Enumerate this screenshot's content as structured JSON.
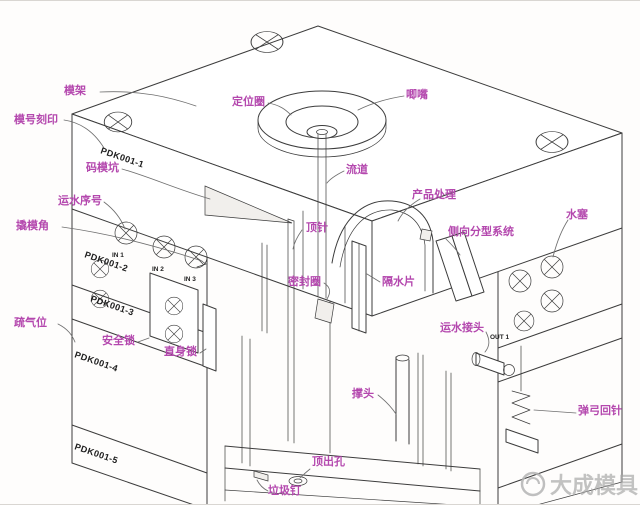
{
  "diagram": {
    "labels": {
      "mold_base": "模架",
      "mold_number_stamp": "模号刻印",
      "clamp_slot": "码模坑",
      "water_line_number": "运水序号",
      "pry_corner": "撬模角",
      "vent_slot": "疏气位",
      "safety_lock": "安全锁",
      "straight_lock": "直身锁",
      "locating_ring": "定位圈",
      "sprue_bush": "唧嘴",
      "runner": "流道",
      "product_area": "产品处理",
      "side_parting_system": "侧向分型系统",
      "ejector_pin": "顶针",
      "seal_ring": "密封圈",
      "water_baffle": "隔水片",
      "water_plug": "水塞",
      "water_fitting": "运水接头",
      "support_pillar": "撑头",
      "spring_return_pin": "弹弓回针",
      "ejection_hole": "顶出孔",
      "stop_pin": "垃圾钉"
    },
    "plate_numbers": {
      "p1": "PDK001-1",
      "p2": "PDK001-2",
      "p3": "PDK001-3",
      "p4": "PDK001-4",
      "p5": "PDK001-5"
    },
    "ports": {
      "in1": "IN 1",
      "in2": "IN 2",
      "in3": "IN 3",
      "out1": "OUT 1"
    },
    "watermark": {
      "text": "大成模具"
    },
    "colors": {
      "label": "#b448ae",
      "line": "#3c3c3c",
      "watermark": "#a7a7a7"
    }
  }
}
